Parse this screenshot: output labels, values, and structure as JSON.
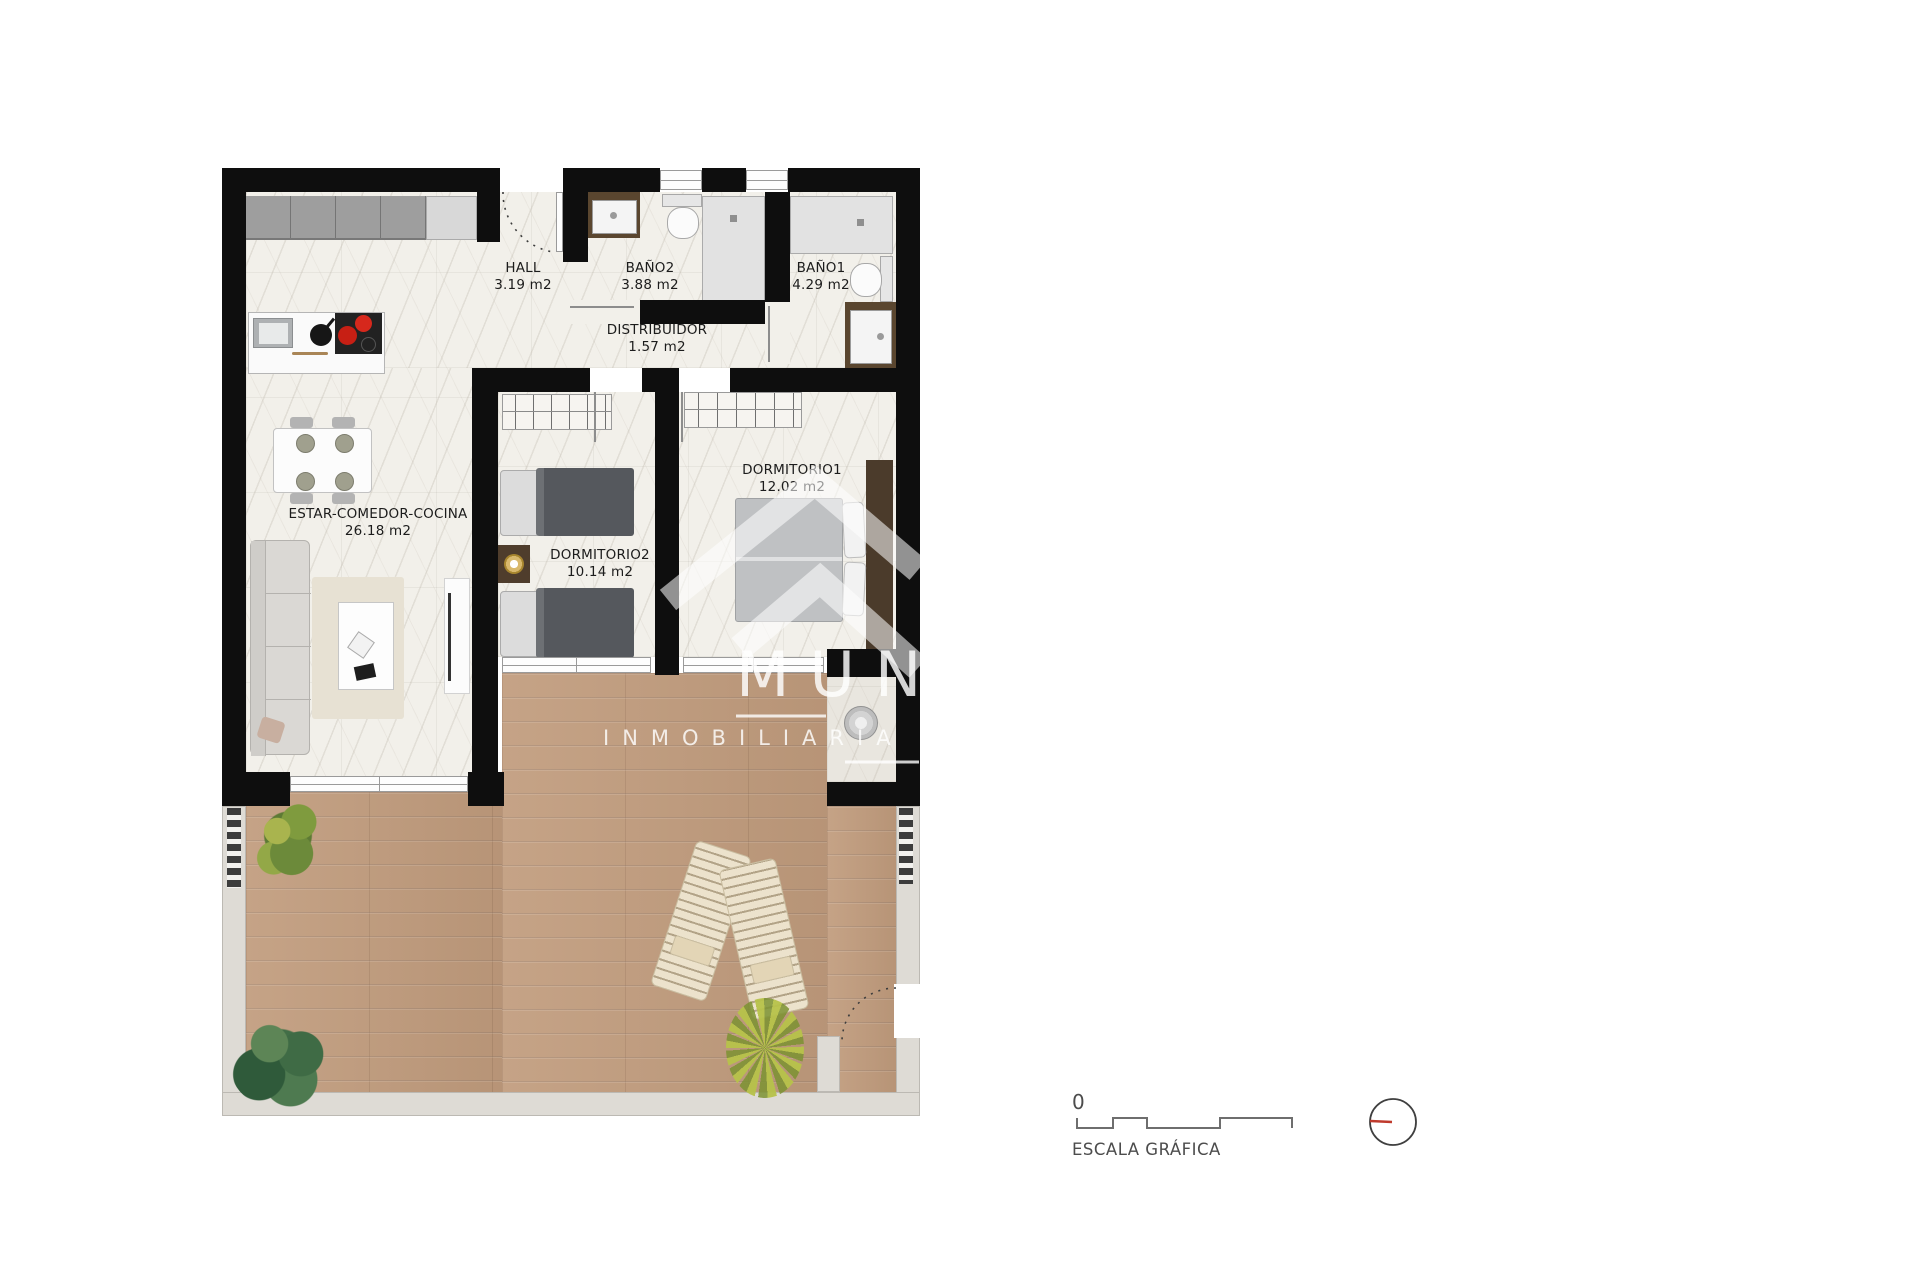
{
  "plan": {
    "rooms": {
      "estar": {
        "name": "ESTAR-COMEDOR-COCINA",
        "area": "26.18 m2"
      },
      "hall": {
        "name": "HALL",
        "area": "3.19 m2"
      },
      "bano2": {
        "name": "BAÑO2",
        "area": "3.88 m2"
      },
      "bano1": {
        "name": "BAÑO1",
        "area": "4.29 m2"
      },
      "distribuidor": {
        "name": "DISTRIBUIDOR",
        "area": "1.57 m2"
      },
      "dormitorio2": {
        "name": "DORMITORIO2",
        "area": "10.14 m2"
      },
      "dormitorio1": {
        "name": "DORMITORIO1",
        "area": "12.02 m2"
      }
    },
    "watermark": {
      "letters": "MUND",
      "sub": "INMOBILIARIA"
    },
    "colors": {
      "wall": "#0e0e0e",
      "marble": "#f2f0ea",
      "wood": "#c19c7d",
      "stone": "#dedbd5",
      "hob_red": "#d6281c",
      "north_red": "#bf3a2c",
      "watermark": "#ffffff"
    }
  },
  "legend": {
    "zero": "0",
    "scale_label": "ESCALA GRÁFICA",
    "north": "N"
  }
}
